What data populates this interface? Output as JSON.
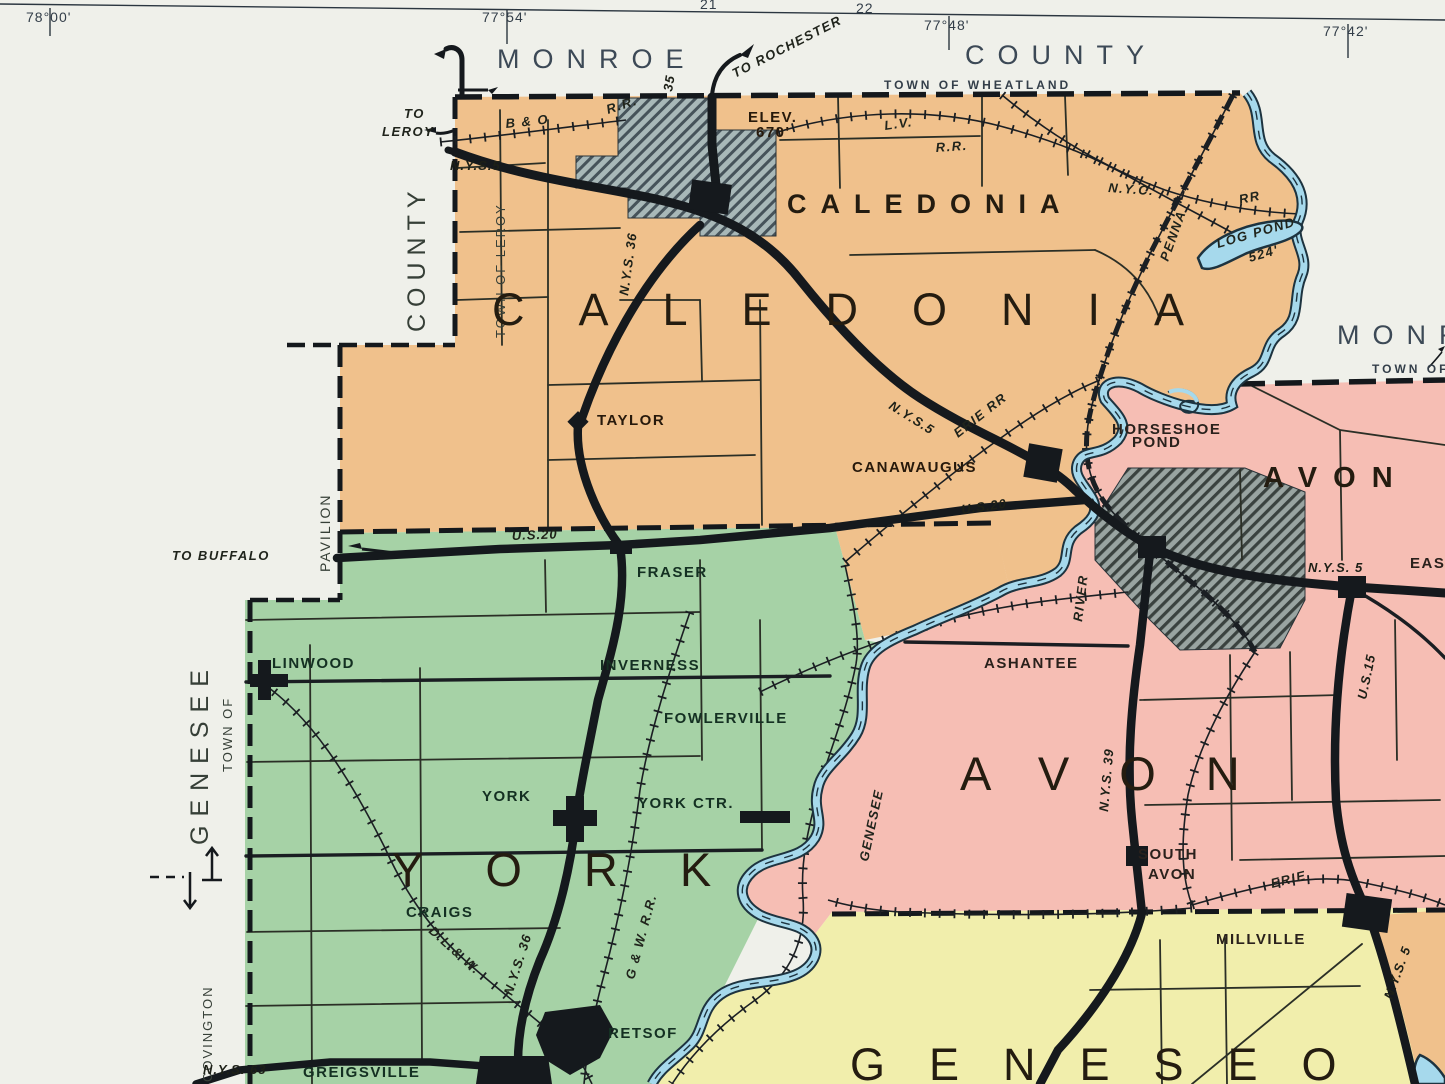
{
  "title": "Vintage highway map sheet — Caledonia / York / Avon / Geneseo (Livingston County, NY)",
  "colors": {
    "paper": "#eff0ea",
    "caledonia_orange": "#f0c18c",
    "york_green": "#a6d2a6",
    "avon_pink": "#f6beb4",
    "geneseo_yellow": "#f1eeac",
    "river_blue": "#a6d9ec",
    "river_outline": "#1d333f",
    "village_hatch": "#a8b8b8",
    "ink": "#15191d"
  },
  "margin": {
    "lon1": "78°00'",
    "lon2": "77°54'",
    "lon3": "77°48'",
    "lon4": "77°42'",
    "grid1": "21",
    "grid2": "22",
    "monroe_top": "MONROE",
    "county_top": "COUNTY",
    "wheatland": "TOWN OF WHEATLAND",
    "to_rochester": "TO ROCHESTER",
    "monroe_right": "MONROE",
    "town_of_right": "TOWN OF",
    "county_left": "COUNTY",
    "town_of_leroy": "TOWN OF LEROY",
    "to_word": "TO",
    "leroy_word": "LEROY",
    "genesee_left": "GENESEE",
    "town_of_left": "TOWN OF",
    "pavilion": "PAVILION",
    "to_buffalo": "TO BUFFALO",
    "covington": "COVINGTON"
  },
  "towns": {
    "caledonia": "CALEDONIA",
    "york": "YORK",
    "avon": "AVON",
    "geneseo": "GENESEO"
  },
  "villages": {
    "caledonia": "CALEDONIA",
    "avon": "AVON"
  },
  "places": {
    "taylor": "TAYLOR",
    "canawaugus": "CANAWAUGUS",
    "fraser": "FRASER",
    "linwood": "LINWOOD",
    "inverness": "INVERNESS",
    "fowlerville": "FOWLERVILLE",
    "york": "YORK",
    "york_ctr": "YORK CTR.",
    "craigs": "CRAIGS",
    "retsof": "RETSOF",
    "greigsville": "GREIGSVILLE",
    "ashantee": "ASHANTEE",
    "east_avon": "EAST AVON",
    "south_avon1": "SOUTH",
    "south_avon2": "AVON",
    "millville": "MILLVILLE",
    "elev1": "ELEV.",
    "elev2": "670'"
  },
  "water": {
    "river_word1": "GENESEE",
    "river_word2": "RIVER",
    "log_pond": "LOG POND",
    "log_pond_elev": "524'",
    "horseshoe1": "HORSESHOE",
    "horseshoe2": "POND"
  },
  "railroads": {
    "bo": "B & O",
    "bo_rr": "R.R.",
    "lv": "L.V.",
    "lv_rr": "R.R.",
    "nyc": "N.Y.C.",
    "penna": "PENNA",
    "penna_rr": "RR",
    "erie_north": "ERIE RR",
    "erie_south": "ERIE",
    "gw": "G & W. R.R.",
    "dlw": "D.L.& W."
  },
  "routes": {
    "nys5_west": "N.Y.S.5",
    "nys5_mid": "N.Y.S.5",
    "nys5_avon": "N.Y.S. 5",
    "nys5_south": "N.Y.S. 5",
    "nys36_north": "N.Y.S. 36",
    "nys36_south": "N.Y.S. 36",
    "us20_west": "U.S.20",
    "us20_east": "U.S.20",
    "nys39": "N.Y.S. 39",
    "us15": "U.S.15",
    "nys63": "N.Y.S. 63",
    "r35": "35"
  }
}
